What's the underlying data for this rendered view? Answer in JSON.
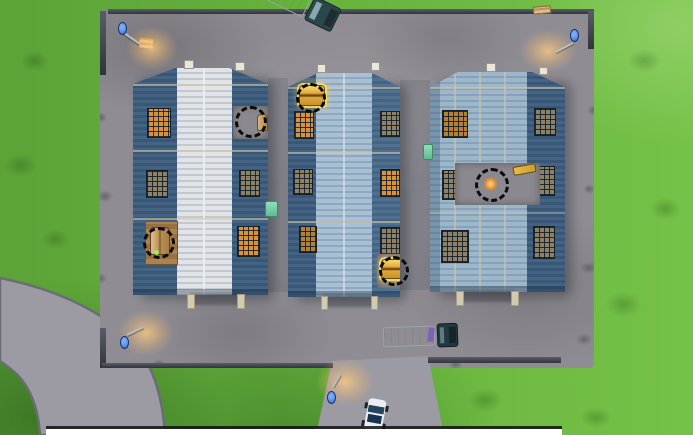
{
  "scene": {
    "type": "top-down game map screenshot",
    "location": "warehouse depot with three storage buildings",
    "annotations": "five dashed circles marking loot chest locations"
  },
  "colors": {
    "grass": "#67b23e",
    "road": "#9c9aa2",
    "asphalt": "#8f8d93",
    "wall": "#3a3d45",
    "roof-white": "#dfe3e6",
    "roof-blue": "#a9bfd3",
    "roof-blue-rib": "#8ea9bf",
    "roof-blue2": "#9db6ca",
    "roof-blue2-rib": "#86a2b9",
    "panel-dark": "#3b5c7d",
    "panel-mid": "#48698b",
    "seam": "#d3c9a6",
    "window-lit": "#d8923a",
    "window-dim": "#8c8268",
    "chest-gold": "#e8b13f",
    "chest-wood": "#caa15c",
    "marker-ring": "#0b0b0b",
    "lamp-blue": "#2f6fd6",
    "lamp-glow": "#ffcc82"
  },
  "markers": [
    {
      "name": "chest-marker-left-warehouse-top",
      "x": 251,
      "y": 122,
      "r": 16,
      "contents": "roof opening with wooden chest"
    },
    {
      "name": "chest-marker-left-warehouse-bottom",
      "x": 159,
      "y": 243,
      "r": 16,
      "contents": "wooden chest on wood floor"
    },
    {
      "name": "chest-marker-middle-warehouse-top",
      "x": 311,
      "y": 98,
      "r": 15,
      "contents": "golden chest"
    },
    {
      "name": "chest-marker-middle-warehouse-bottom",
      "x": 394,
      "y": 271,
      "r": 15,
      "contents": "golden chest"
    },
    {
      "name": "chest-marker-right-warehouse-center",
      "x": 492,
      "y": 185,
      "r": 17,
      "contents": "roof opening with glowing loot"
    }
  ],
  "buildings": [
    {
      "name": "warehouse-left",
      "roof": "white ribbed center, dark blue side panels",
      "lit_windows": 4
    },
    {
      "name": "warehouse-middle",
      "roof": "light blue ribbed center, dark blue side panels",
      "lit_windows": 3
    },
    {
      "name": "warehouse-right",
      "roof": "light blue ribbed with dark blue right panel, roof hole with gold rifle",
      "lit_windows": 1
    }
  ],
  "vehicles": [
    {
      "name": "semi-truck-top",
      "description": "white trailer truck angled at top edge"
    },
    {
      "name": "semi-truck-bottom",
      "description": "white trailer truck parked below buildings"
    },
    {
      "name": "police-car",
      "description": "white and blue car at bottom driveway"
    }
  ],
  "props": [
    {
      "name": "street-lamp",
      "count": 4
    },
    {
      "name": "wooden-pallet",
      "count": 1
    },
    {
      "name": "dumpster-teal",
      "count": 2
    },
    {
      "name": "golden-rifle",
      "count": 1
    }
  ]
}
